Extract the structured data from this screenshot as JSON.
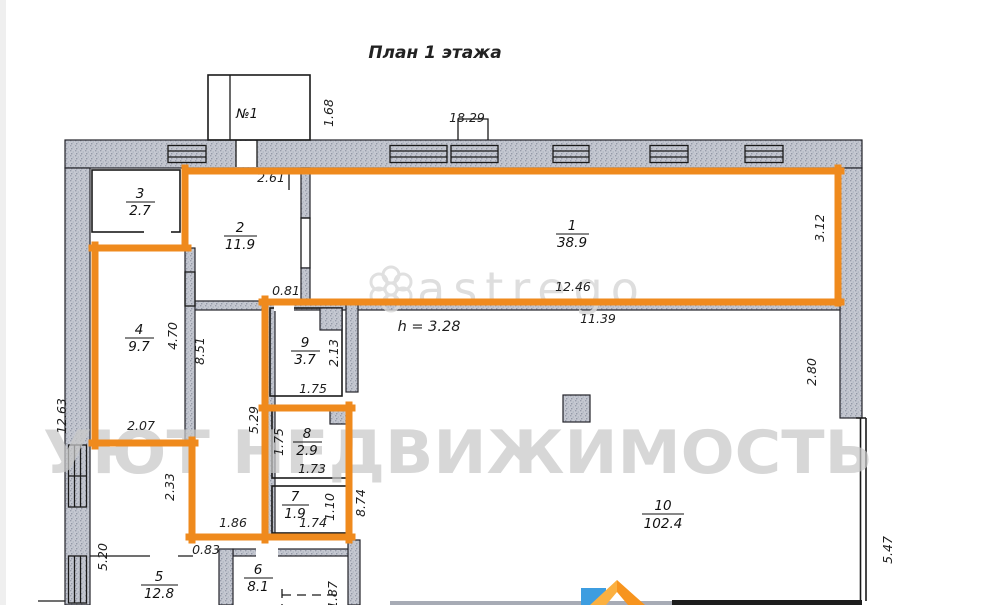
{
  "title": "План 1 этажа",
  "porch_label": "№1",
  "ceiling_note": "h = 3.28",
  "watermark": {
    "brand": "astrego",
    "agency": "УЮТ НЕДВИЖИМОСТЬ"
  },
  "rooms": {
    "r1": {
      "num": "1",
      "area": "38.9"
    },
    "r2": {
      "num": "2",
      "area": "11.9"
    },
    "r3": {
      "num": "3",
      "area": "2.7"
    },
    "r4": {
      "num": "4",
      "area": "9.7"
    },
    "r5": {
      "num": "5",
      "area": "12.8"
    },
    "r6": {
      "num": "6",
      "area": "8.1"
    },
    "r7": {
      "num": "7",
      "area": "1.9"
    },
    "r8": {
      "num": "8",
      "area": "2.9"
    },
    "r9": {
      "num": "9",
      "area": "3.7"
    },
    "r10": {
      "num": "10",
      "area": "102.4"
    }
  },
  "dims": {
    "top_width": "18.29",
    "porch_height": "1.68",
    "room2_top": "2.61",
    "room2_door": "0.81",
    "room1_right": "3.12",
    "room1_bottom": "12.46",
    "hall_top": "11.39",
    "left_total": "12.63",
    "room4_upper": "4.70",
    "room4_wall": "8.51",
    "room4_bottom": "2.07",
    "room9_right": "2.13",
    "room9_bottom": "1.75",
    "hall_left": "5.29",
    "room8_left": "1.75",
    "room8_bottom": "1.73",
    "hall_mid": "2.33",
    "hall_width": "1.86",
    "room7_bottom": "1.74",
    "room7_right": "1.10",
    "room10_wall": "8.74",
    "door_lower": "0.83",
    "left_lower": "5.20",
    "right_upper": "2.80",
    "right_lower": "5.47",
    "room6_right": "1.87"
  },
  "colors": {
    "highlight": "#ef8a1d",
    "watermark": "#c9c9c9",
    "watermark_light": "#d9d9d9",
    "logo_orange": "#f7941e",
    "logo_orange_light": "#fbb040",
    "logo_blue": "#3d9de0"
  }
}
